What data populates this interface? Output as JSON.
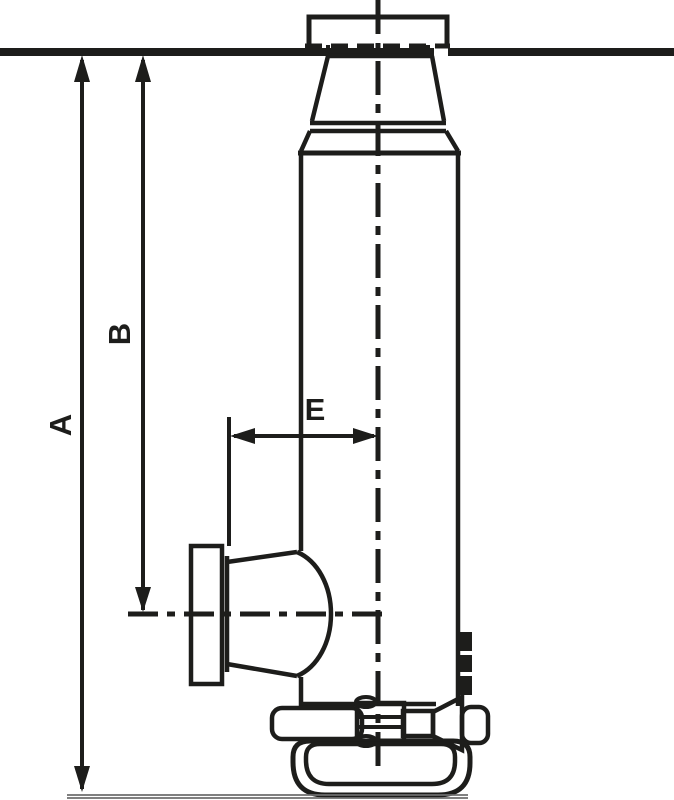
{
  "drawing": {
    "kind": "technical-line-drawing",
    "subject": "hydraulic bottle jack, side elevation with extended ram",
    "colors": {
      "ink": "#1d1d1b",
      "ground_line": "#6f6f6f",
      "background": "#ffffff"
    },
    "labels": {
      "a": "A",
      "b": "B",
      "e": "E"
    },
    "parts": [
      "saddle-plate",
      "ram-cap",
      "cylinder-body",
      "pump-flange",
      "pump-boss",
      "handle-sleeve",
      "linkage-joint",
      "release-valve-cone",
      "release-knob",
      "base-foot"
    ]
  }
}
